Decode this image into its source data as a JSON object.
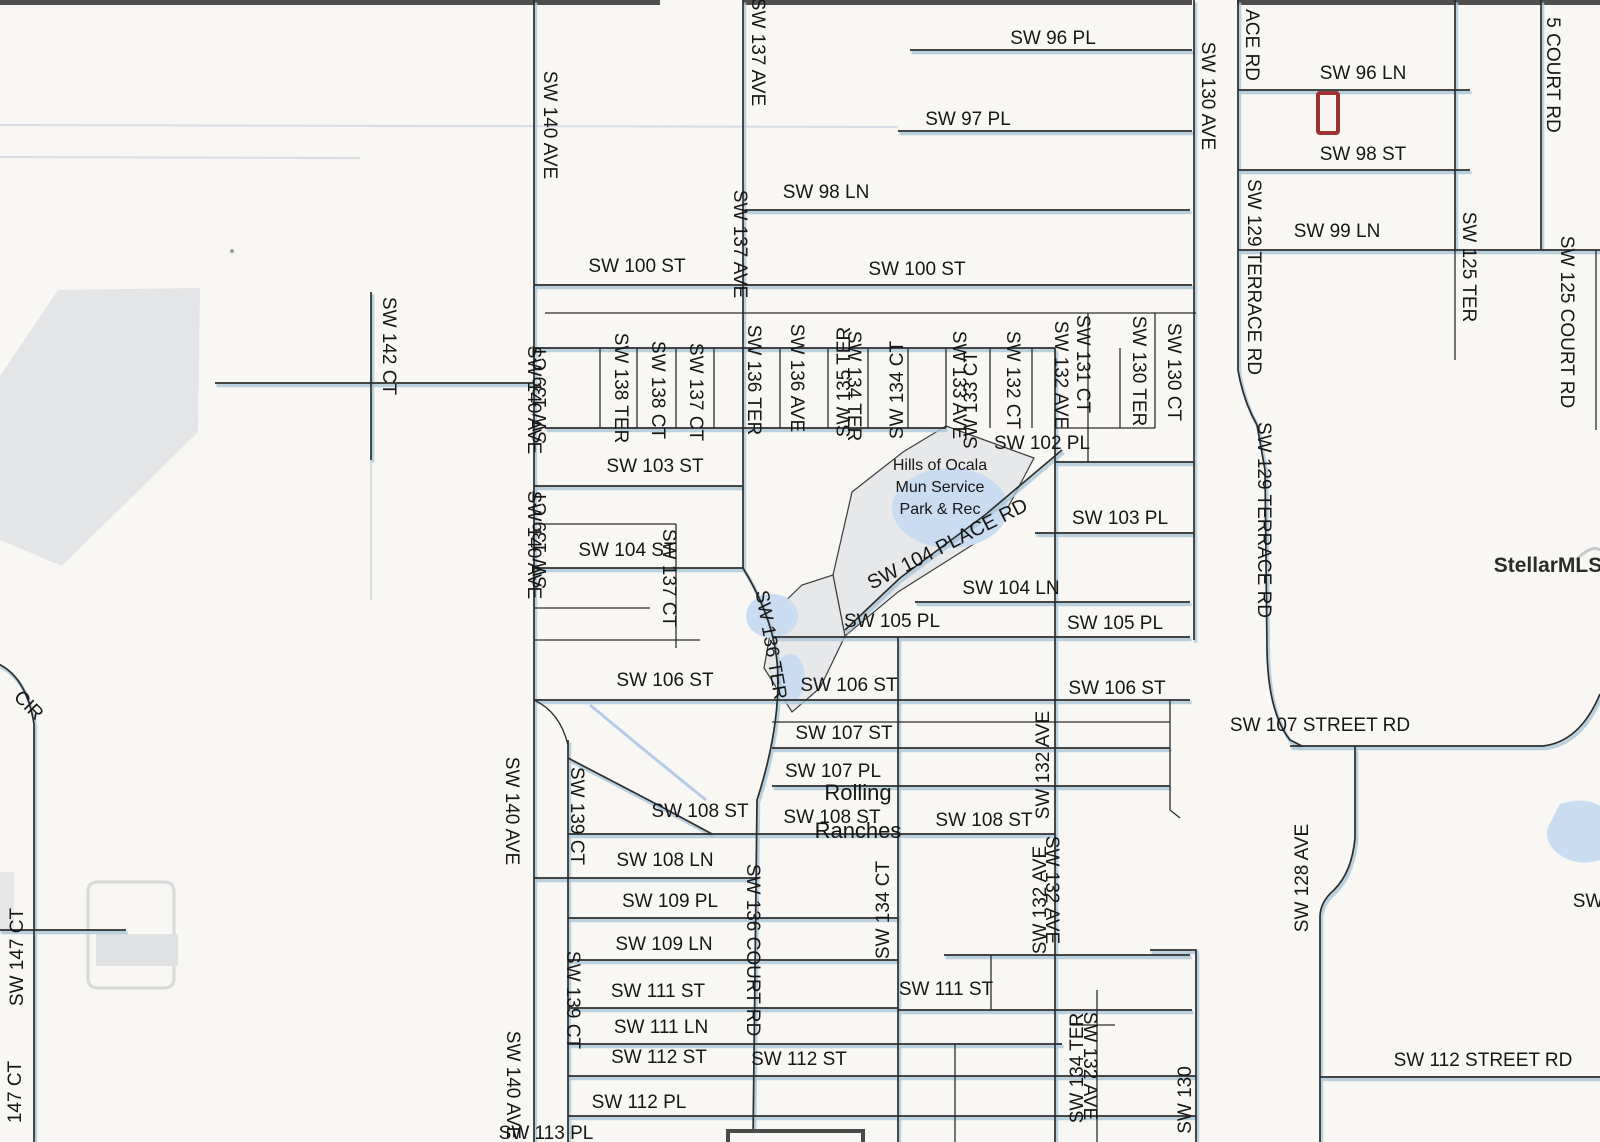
{
  "map": {
    "title": "Street plat map - Rolling Ranches / Hills of Ocala area",
    "width": 1600,
    "height": 1142,
    "background": "#f8f7f3",
    "road_color": "#2d2d2d",
    "road_shadow_color": "#a9c6d8",
    "faint_road_color": "#d7dde3",
    "water_color": "#c9dcf2",
    "park_fill": "#e7e8ea",
    "park_text_color": "#b3c0d4",
    "marker_color": "#9e3132",
    "inset_box_color": "#4a4a4a",
    "watermark_color": "#c6c9cc",
    "top_edge_color": "#4e4e4e"
  },
  "watermark": {
    "text": "StellarMLS",
    "x": 1548,
    "y": 572,
    "fs": 21
  },
  "markers": {
    "subject_property": {
      "x": 1318,
      "y": 93,
      "w": 20,
      "h": 40
    },
    "inset_box": {
      "x": 728,
      "y": 1131,
      "w": 135,
      "h": 14
    }
  },
  "park": {
    "name_lines": [
      "Hills of Ocala",
      "Mun Service",
      "Park & Rec"
    ],
    "text_x": 940,
    "text_y": 470,
    "line_h": 22,
    "fs": 16
  },
  "area_label": {
    "lines": [
      "Rolling",
      "Ranches"
    ],
    "x": 858,
    "y": 800,
    "line_h": 38,
    "fs": 22
  },
  "roads": [
    {
      "d": "M910,50 L1192,50",
      "k": "m"
    },
    {
      "d": "M1238,90 L1470,90",
      "k": "m"
    },
    {
      "d": "M898,131 L1192,131",
      "k": "m"
    },
    {
      "d": "M0,125 L898,127",
      "k": "f"
    },
    {
      "d": "M0,157 L360,158",
      "k": "f"
    },
    {
      "d": "M1238,170 L1470,170",
      "k": "m"
    },
    {
      "d": "M745,210 L1190,210",
      "k": "m"
    },
    {
      "d": "M1238,250 L1600,250",
      "k": "m"
    },
    {
      "d": "M534,285 L1192,285",
      "k": "m"
    },
    {
      "d": "M545,313 L1196,313",
      "k": "t"
    },
    {
      "d": "M534,348 L1055,348",
      "k": "m"
    },
    {
      "d": "M215,383 L534,383",
      "k": "m"
    },
    {
      "d": "M545,428 L946,428",
      "k": "m"
    },
    {
      "d": "M1055,428 L1155,428",
      "k": "t"
    },
    {
      "d": "M1055,462 L1194,462",
      "k": "m"
    },
    {
      "d": "M534,486 L743,486",
      "k": "m"
    },
    {
      "d": "M534,524 L676,524",
      "k": "t"
    },
    {
      "d": "M1035,533 L1194,533",
      "k": "m"
    },
    {
      "d": "M534,568 L743,568",
      "k": "m"
    },
    {
      "d": "M915,602 L1190,602",
      "k": "m"
    },
    {
      "d": "M534,608 L650,608",
      "k": "t"
    },
    {
      "d": "M772,637 L1190,637",
      "k": "m"
    },
    {
      "d": "M534,640 L700,640",
      "k": "t"
    },
    {
      "d": "M534,700 L1190,700",
      "k": "m"
    },
    {
      "d": "M772,722 L1170,722",
      "k": "t"
    },
    {
      "d": "M772,748 L1170,748",
      "k": "m"
    },
    {
      "d": "M772,786 L1170,786",
      "k": "m"
    },
    {
      "d": "M1290,746 L1543,746 Q1580,742 1600,694",
      "k": "m"
    },
    {
      "d": "M568,834 L1055,834",
      "k": "m"
    },
    {
      "d": "M534,878 L758,878",
      "k": "m"
    },
    {
      "d": "M568,918 L898,918",
      "k": "m"
    },
    {
      "d": "M568,960 L898,960",
      "k": "m"
    },
    {
      "d": "M944,955 L1190,955",
      "k": "m"
    },
    {
      "d": "M568,1008 L898,1008",
      "k": "m"
    },
    {
      "d": "M898,1010 L1192,1010",
      "k": "m"
    },
    {
      "d": "M1070,1025 L1115,1025",
      "k": "t"
    },
    {
      "d": "M568,1044 L1062,1044",
      "k": "m"
    },
    {
      "d": "M568,1076 L1196,1076",
      "k": "m"
    },
    {
      "d": "M1320,1077 L1600,1077",
      "k": "m"
    },
    {
      "d": "M568,1116 L1196,1116",
      "k": "m"
    },
    {
      "d": "M0,930 L126,930",
      "k": "m"
    },
    {
      "d": "M1062,450 L985,515 L900,578 L845,630",
      "k": "m"
    },
    {
      "d": "M534,0 L534,1142",
      "k": "m"
    },
    {
      "d": "M568,740 L568,1142",
      "k": "m"
    },
    {
      "d": "M534,700 Q560,712 568,745",
      "k": "t"
    },
    {
      "d": "M568,758 L660,806 L712,834",
      "k": "m"
    },
    {
      "d": "M743,0 L743,568",
      "k": "m"
    },
    {
      "d": "M743,568 Q778,625 778,680 Q778,735 757,800 L753,1142",
      "k": "m"
    },
    {
      "d": "M600,348 L600,428",
      "k": "t"
    },
    {
      "d": "M637,348 L637,428",
      "k": "t"
    },
    {
      "d": "M676,348 L676,428",
      "k": "t"
    },
    {
      "d": "M714,348 L714,428",
      "k": "t"
    },
    {
      "d": "M780,348 L780,428",
      "k": "t"
    },
    {
      "d": "M828,348 L828,428",
      "k": "t"
    },
    {
      "d": "M868,348 L868,428",
      "k": "t"
    },
    {
      "d": "M908,348 L908,428",
      "k": "t"
    },
    {
      "d": "M946,348 L946,428",
      "k": "t"
    },
    {
      "d": "M990,348 L990,428",
      "k": "t"
    },
    {
      "d": "M1032,348 L1032,428",
      "k": "t"
    },
    {
      "d": "M676,524 L676,648",
      "k": "t"
    },
    {
      "d": "M898,637 L898,1142",
      "k": "m"
    },
    {
      "d": "M955,1044 L955,1142",
      "k": "t"
    },
    {
      "d": "M991,955 L991,1010",
      "k": "t"
    },
    {
      "d": "M1055,348 L1055,1142",
      "k": "m"
    },
    {
      "d": "M1088,313 L1088,462",
      "k": "t"
    },
    {
      "d": "M1097,990 L1097,1142",
      "k": "t"
    },
    {
      "d": "M1120,348 L1120,428",
      "k": "t"
    },
    {
      "d": "M1155,313 L1155,428",
      "k": "t"
    },
    {
      "d": "M1170,700 L1170,810 L1180,818",
      "k": "t"
    },
    {
      "d": "M1194,0 L1194,640",
      "k": "m"
    },
    {
      "d": "M1150,950 L1196,950 L1196,1142",
      "k": "m"
    },
    {
      "d": "M1238,0 L1238,370 Q1243,400 1257,425 L1265,470 L1267,650 Q1268,712 1290,740 L1302,746",
      "k": "m"
    },
    {
      "d": "M1355,746 L1355,838 Q1352,872 1334,890 Q1320,902 1320,917 L1320,1142",
      "k": "m"
    },
    {
      "d": "M1455,0 L1455,250",
      "k": "m"
    },
    {
      "d": "M1455,250 L1455,360",
      "k": "t"
    },
    {
      "d": "M1541,0 L1541,250",
      "k": "m"
    },
    {
      "d": "M1596,250 L1596,430",
      "k": "t"
    },
    {
      "d": "M371,292 L371,460",
      "k": "m"
    },
    {
      "d": "M371,460 L371,600",
      "k": "f"
    },
    {
      "d": "M-6,662 Q26,674 34,724 L34,1142",
      "k": "m"
    }
  ],
  "shapes": [
    {
      "type": "rect",
      "x": 0,
      "y": 0,
      "w": 660,
      "h": 5,
      "fill": "#4e4e4e"
    },
    {
      "type": "rect",
      "x": 743,
      "y": 0,
      "w": 449,
      "h": 5,
      "fill": "#4e4e4e"
    },
    {
      "type": "rect",
      "x": 1237,
      "y": 0,
      "w": 363,
      "h": 5,
      "fill": "#4e4e4e"
    },
    {
      "type": "polygon",
      "pts": "58,290 200,288 198,432 62,566 0,540 0,376",
      "fill": "#e4e5e7"
    },
    {
      "type": "polygon",
      "pts": "946,426 1034,458 996,530 898,592 845,636 833,575 852,492 903,452",
      "fill": "#e7e8ea",
      "stroke": "#3c3c3c",
      "sw": 1.2
    },
    {
      "type": "polygon",
      "pts": "833,575 845,636 820,688 792,712 764,668 774,612 802,585",
      "fill": "#e7e8ea",
      "stroke": "#3c3c3c",
      "sw": 1.2
    },
    {
      "type": "ellipse",
      "cx": 950,
      "cy": 508,
      "rx": 58,
      "ry": 40,
      "fill": "#c9dcf2"
    },
    {
      "type": "ellipse",
      "cx": 772,
      "cy": 616,
      "rx": 26,
      "ry": 22,
      "fill": "#c9dcf2"
    },
    {
      "type": "ellipse",
      "cx": 790,
      "cy": 678,
      "rx": 15,
      "ry": 24,
      "fill": "#c9dcf2"
    },
    {
      "type": "path",
      "d": "M1560,804 Q1586,796 1600,806 L1600,860 Q1576,868 1556,852 Q1540,836 1552,820 Q1556,810 1560,804 Z",
      "fill": "#c9dcf2"
    },
    {
      "type": "path",
      "d": "M590,705 Q650,755 706,800",
      "stroke": "#a9c4e4",
      "sw": 3,
      "fill": "none",
      "op": 0.85
    },
    {
      "type": "path",
      "d": "M98,882 h66 q10,0 10,10 v86 q0,10 -10,10 h-66 q-10,0 -10,-10 v-86 q0,-10 10,-10",
      "stroke": "#d8d9db",
      "sw": 3,
      "fill": "none"
    },
    {
      "type": "rect",
      "x": 96,
      "y": 934,
      "w": 82,
      "h": 32,
      "fill": "#dfe1e3"
    },
    {
      "type": "rect",
      "x": 0,
      "y": 872,
      "w": 14,
      "h": 62,
      "fill": "#e6e7e9"
    },
    {
      "type": "path",
      "d": "M1576,560 Q1592,544 1600,550",
      "stroke": "#c6c9cc",
      "sw": 3,
      "fill": "none"
    },
    {
      "type": "circle",
      "cx": 232,
      "cy": 251,
      "r": 2,
      "fill": "#9a9a9a"
    }
  ],
  "labels": [
    {
      "t": "SW 96 PL",
      "x": 1053,
      "y": 39
    },
    {
      "t": "SW 96 LN",
      "x": 1363,
      "y": 74
    },
    {
      "t": "SW 97 PL",
      "x": 968,
      "y": 120
    },
    {
      "t": "SW 98 ST",
      "x": 1363,
      "y": 155
    },
    {
      "t": "SW 98 LN",
      "x": 826,
      "y": 193
    },
    {
      "t": "SW 99 LN",
      "x": 1337,
      "y": 232
    },
    {
      "t": "SW 100 ST",
      "x": 637,
      "y": 267
    },
    {
      "t": "SW 100 ST",
      "x": 917,
      "y": 270
    },
    {
      "t": "SW 102 PL",
      "x": 1042,
      "y": 444
    },
    {
      "t": "SW 103 ST",
      "x": 655,
      "y": 467
    },
    {
      "t": "SW 103 PL",
      "x": 1120,
      "y": 519
    },
    {
      "t": "SW 104 ST",
      "x": 627,
      "y": 551
    },
    {
      "t": "SW 104 LN",
      "x": 1011,
      "y": 589
    },
    {
      "t": "SW 105 PL",
      "x": 892,
      "y": 622
    },
    {
      "t": "SW 105 PL",
      "x": 1115,
      "y": 624
    },
    {
      "t": "SW 106 ST",
      "x": 665,
      "y": 681
    },
    {
      "t": "SW 106 ST",
      "x": 849,
      "y": 686
    },
    {
      "t": "SW 106 ST",
      "x": 1117,
      "y": 689
    },
    {
      "t": "SW 107 ST",
      "x": 844,
      "y": 734
    },
    {
      "t": "SW 107 PL",
      "x": 833,
      "y": 772
    },
    {
      "t": "SW 108 ST",
      "x": 700,
      "y": 812
    },
    {
      "t": "SW 108 ST",
      "x": 832,
      "y": 818
    },
    {
      "t": "SW 108 ST",
      "x": 984,
      "y": 821
    },
    {
      "t": "SW 108 LN",
      "x": 665,
      "y": 861
    },
    {
      "t": "SW 109 PL",
      "x": 670,
      "y": 902
    },
    {
      "t": "SW 109 LN",
      "x": 664,
      "y": 945
    },
    {
      "t": "SW 111 ST",
      "x": 658,
      "y": 992
    },
    {
      "t": "SW 111 ST",
      "x": 946,
      "y": 990
    },
    {
      "t": "SW 111 LN",
      "x": 661,
      "y": 1028
    },
    {
      "t": "SW 112 ST",
      "x": 659,
      "y": 1058
    },
    {
      "t": "SW 112 ST",
      "x": 799,
      "y": 1060
    },
    {
      "t": "SW 112 PL",
      "x": 639,
      "y": 1103
    },
    {
      "t": "SW 113 PL",
      "x": 546,
      "y": 1134
    },
    {
      "t": "SW 107 STREET RD",
      "x": 1320,
      "y": 726
    },
    {
      "t": "SW 112 STREET RD",
      "x": 1483,
      "y": 1061
    },
    {
      "t": "SW",
      "x": 1588,
      "y": 902
    },
    {
      "t": "SW 140 AVE",
      "x": 549,
      "y": 125,
      "d": "d"
    },
    {
      "t": "SW 137 AVE",
      "x": 757,
      "y": 52,
      "d": "d"
    },
    {
      "t": "SW 137 AVE",
      "x": 739,
      "y": 244,
      "d": "d"
    },
    {
      "t": "SW 130 AVE",
      "x": 1207,
      "y": 96,
      "d": "d"
    },
    {
      "t": "ACE RD",
      "x": 1251,
      "y": 45,
      "d": "d"
    },
    {
      "t": "SW 129 TERRACE RD",
      "x": 1253,
      "y": 277,
      "d": "d"
    },
    {
      "t": "SW 129 TERRACE RD",
      "x": 1263,
      "y": 520,
      "d": "d"
    },
    {
      "t": "SW 125 TER",
      "x": 1468,
      "y": 267,
      "d": "d"
    },
    {
      "t": "5 COURT RD",
      "x": 1552,
      "y": 75,
      "d": "d"
    },
    {
      "t": "SW 125 COURT RD",
      "x": 1566,
      "y": 322,
      "d": "d"
    },
    {
      "t": "SW 142 CT",
      "x": 388,
      "y": 346,
      "d": "d"
    },
    {
      "t": "SW 138 TER",
      "x": 620,
      "y": 388,
      "d": "d"
    },
    {
      "t": "SW 138 CT",
      "x": 657,
      "y": 390,
      "d": "d"
    },
    {
      "t": "SW 137 CT",
      "x": 695,
      "y": 392,
      "d": "d"
    },
    {
      "t": "SW 136 TER",
      "x": 753,
      "y": 380,
      "d": "d"
    },
    {
      "t": "SW 136 AVE",
      "x": 796,
      "y": 378,
      "d": "d"
    },
    {
      "t": "SW 135 TER",
      "x": 845,
      "y": 382,
      "d": "u"
    },
    {
      "t": "SW 134 TER",
      "x": 853,
      "y": 386,
      "d": "d"
    },
    {
      "t": "SW 134 CT",
      "x": 898,
      "y": 390,
      "d": "u"
    },
    {
      "t": "SW 133 AVE",
      "x": 958,
      "y": 385,
      "d": "d"
    },
    {
      "t": "SW 133 CT",
      "x": 972,
      "y": 400,
      "d": "u"
    },
    {
      "t": "SW 132 CT",
      "x": 1012,
      "y": 380,
      "d": "d"
    },
    {
      "t": "SW 132 AVE",
      "x": 1060,
      "y": 375,
      "d": "d"
    },
    {
      "t": "SW 131 CT",
      "x": 1082,
      "y": 364,
      "d": "d"
    },
    {
      "t": "SW 130 TER",
      "x": 1138,
      "y": 371,
      "d": "d"
    },
    {
      "t": "SW 130 CT",
      "x": 1173,
      "y": 372,
      "d": "d"
    },
    {
      "t": "SW 140 AVE",
      "x": 533,
      "y": 400,
      "d": "d"
    },
    {
      "t": "SW 139 CT",
      "x": 541,
      "y": 395,
      "d": "u"
    },
    {
      "t": "SW 140 AVE",
      "x": 533,
      "y": 545,
      "d": "d"
    },
    {
      "t": "SW 139 CT",
      "x": 541,
      "y": 540,
      "d": "u"
    },
    {
      "t": "SW 137 CT",
      "x": 668,
      "y": 578,
      "d": "d"
    },
    {
      "t": "SW 136 TER",
      "x": 770,
      "y": 645,
      "d": 80
    },
    {
      "t": "SW 140 AVE",
      "x": 511,
      "y": 811,
      "d": "d"
    },
    {
      "t": "SW 139 CT",
      "x": 576,
      "y": 816,
      "d": "d"
    },
    {
      "t": "SW 139 CT",
      "x": 572,
      "y": 1000,
      "d": "d"
    },
    {
      "t": "SW 140 AVE",
      "x": 512,
      "y": 1085,
      "d": "d"
    },
    {
      "t": "SW 136 COURT RD",
      "x": 752,
      "y": 950,
      "d": "d"
    },
    {
      "t": "SW 134 CT",
      "x": 884,
      "y": 910,
      "d": "u"
    },
    {
      "t": "SW 132 AVE",
      "x": 1044,
      "y": 765,
      "d": "u"
    },
    {
      "t": "SW 132 AVE",
      "x": 1041,
      "y": 900,
      "d": "u"
    },
    {
      "t": "SW 132 AVE",
      "x": 1051,
      "y": 890,
      "d": "d"
    },
    {
      "t": "SW 134 TER",
      "x": 1078,
      "y": 1068,
      "d": "u"
    },
    {
      "t": "SW 132 AVE",
      "x": 1089,
      "y": 1066,
      "d": "d"
    },
    {
      "t": "SW 130",
      "x": 1186,
      "y": 1100,
      "d": "u"
    },
    {
      "t": "SW 128 AVE",
      "x": 1303,
      "y": 878,
      "d": "u"
    },
    {
      "t": "CIR",
      "x": 28,
      "y": 706,
      "d": 45
    },
    {
      "t": "SW 147 CT",
      "x": 18,
      "y": 957,
      "d": "u"
    },
    {
      "t": "147 CT",
      "x": 16,
      "y": 1092,
      "d": "u"
    },
    {
      "t": "SW 104 PLACE RD",
      "x": 948,
      "y": 545,
      "d": -27,
      "fs": 20
    }
  ]
}
